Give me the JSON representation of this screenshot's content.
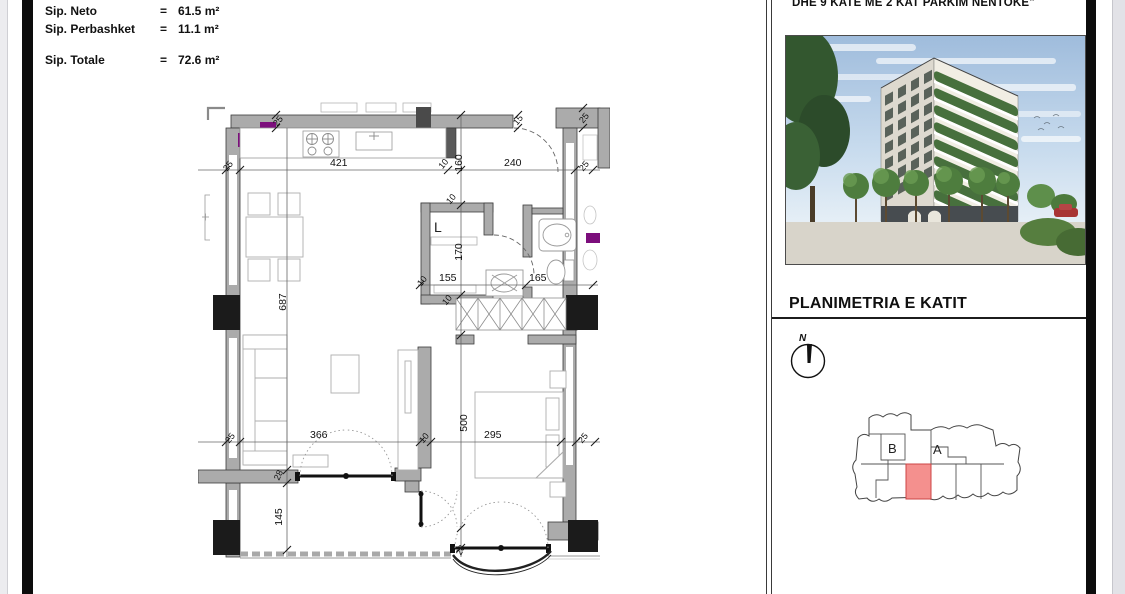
{
  "areas": {
    "rows": [
      {
        "label": "Sip. Neto",
        "eq": "=",
        "value": "61.5 m²"
      },
      {
        "label": "Sip. Perbashket",
        "eq": "=",
        "value": "11.1 m²"
      },
      {
        "label": "Sip. Totale",
        "eq": "=",
        "value": "72.6 m²"
      }
    ]
  },
  "header": {
    "project_note": "DHE 9 KATE ME 2 KAT PARKIM NENTOKE\""
  },
  "panel": {
    "title": "PLANIMETRIA E KATIT",
    "north_label": "N",
    "keyplan": {
      "block_b": "B",
      "block_a": "A",
      "highlight_color": "#f4908e"
    }
  },
  "plan": {
    "room_label": "L",
    "dims": {
      "top_25_left": "25",
      "top_421": "421",
      "top_10": "10",
      "top_160": "160",
      "top_240": "240",
      "top_25_right": "25",
      "wall_25_top_left": "25",
      "wall_15_top": "15",
      "wall_25_top_right": "25",
      "mid_10": "10",
      "mid_155": "155",
      "mid_165": "165",
      "wc_10_top": "10",
      "wc_10_bottom": "10",
      "wc_170": "170",
      "living_687": "687",
      "corridor_500": "500",
      "balcony_145": "145",
      "wall_28_left": "28",
      "wall_28_bottom": "28",
      "bot_25_left": "25",
      "bot_366": "366",
      "bot_10": "10",
      "bot_295": "295",
      "bot_25_right": "25"
    }
  },
  "colors": {
    "wall_fill": "#ababab",
    "column_fill": "#1b1b1b",
    "accent_purple": "#7c0e7c",
    "highlight_red": "#f4908e"
  }
}
